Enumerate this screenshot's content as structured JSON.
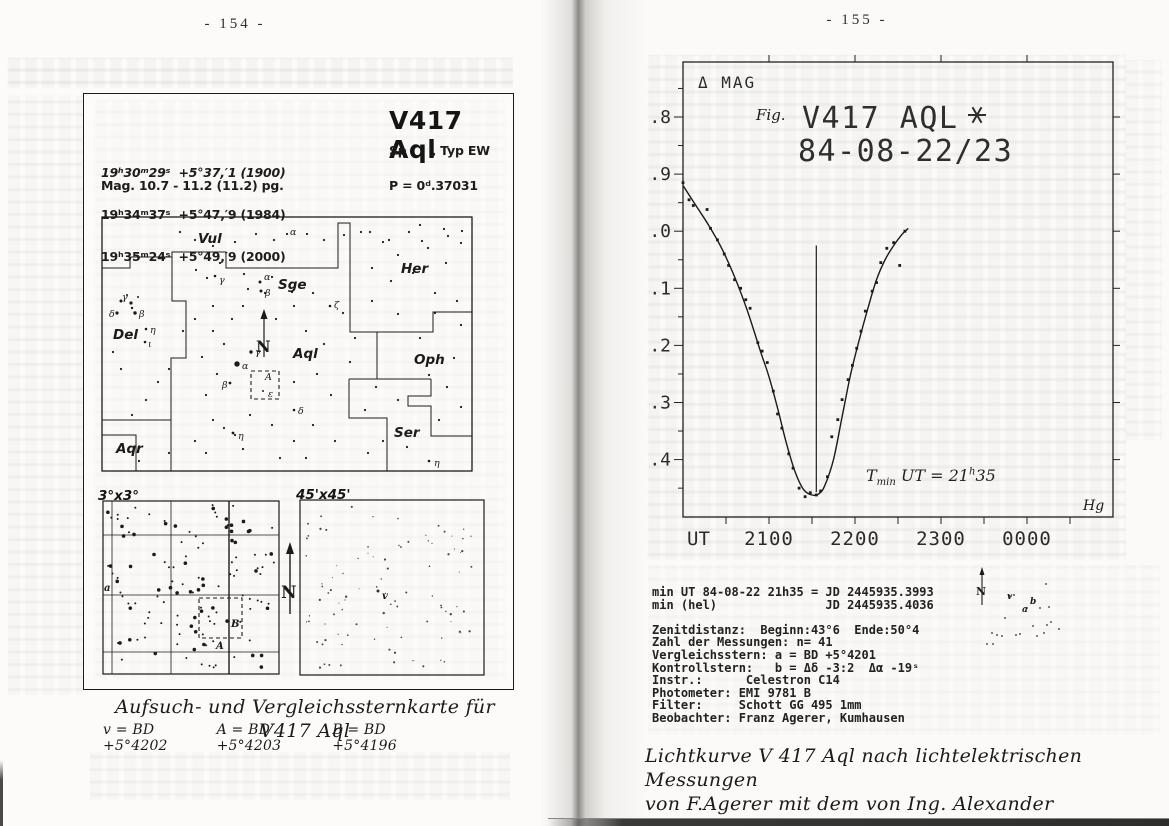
{
  "left": {
    "page_number": "- 154 -",
    "info": {
      "title": "V417 Aql",
      "sp_typ": "Sp      , Typ EW",
      "coordinates": [
        "19ʰ30ᵐ29ˢ  +5°37,′1 (1900)",
        "19ʰ34ᵐ37ˢ  +5°47,′9 (1984)",
        "19ʰ35ᵐ24ˢ  +5°49,′9 (2000)"
      ],
      "magnitude": "Mag. 10.7 - 11.2 (11.2) pg.",
      "period": "P = 0ᵈ.37031"
    },
    "main_map": {
      "north_label": "N",
      "boundaries": [
        [
          [
            0,
            51
          ],
          [
            28,
            51
          ],
          [
            28,
            40
          ],
          [
            70,
            40
          ]
        ],
        [
          [
            70,
            40
          ],
          [
            70,
            35
          ],
          [
            124,
            35
          ],
          [
            124,
            51
          ],
          [
            236,
            51
          ],
          [
            236,
            6
          ],
          [
            248,
            6
          ],
          [
            248,
            115
          ],
          [
            331,
            115
          ],
          [
            331,
            95
          ],
          [
            370,
            95
          ]
        ],
        [
          [
            70,
            35
          ],
          [
            70,
            84
          ],
          [
            84,
            84
          ],
          [
            84,
            141
          ],
          [
            69,
            141
          ],
          [
            69,
            203
          ],
          [
            0,
            203
          ]
        ],
        [
          [
            69,
            203
          ],
          [
            69,
            254
          ]
        ],
        [
          [
            0,
            218
          ],
          [
            34,
            218
          ],
          [
            34,
            254
          ]
        ],
        [
          [
            275,
            115
          ],
          [
            275,
            162
          ]
        ],
        [
          [
            247,
            162
          ],
          [
            329,
            162
          ]
        ],
        [
          [
            247,
            162
          ],
          [
            247,
            201
          ],
          [
            285,
            201
          ],
          [
            285,
            254
          ]
        ],
        [
          [
            329,
            162
          ],
          [
            329,
            179
          ],
          [
            306,
            179
          ],
          [
            306,
            189
          ],
          [
            329,
            189
          ],
          [
            329,
            219
          ],
          [
            370,
            219
          ]
        ]
      ],
      "dashed_box": [
        149,
        154,
        28,
        28
      ],
      "constellation_labels": [
        {
          "t": "Vul",
          "x": 96,
          "y": 26
        },
        {
          "t": "Sge",
          "x": 176,
          "y": 72
        },
        {
          "t": "Her",
          "x": 299,
          "y": 56
        },
        {
          "t": "Del",
          "x": 11,
          "y": 122
        },
        {
          "t": "Aql",
          "x": 191,
          "y": 141
        },
        {
          "t": "Oph",
          "x": 312,
          "y": 147
        },
        {
          "t": "Ser",
          "x": 292,
          "y": 220
        },
        {
          "t": "Aqr",
          "x": 14,
          "y": 236
        }
      ],
      "star_labels": [
        {
          "t": "α",
          "x": 188,
          "y": 18
        },
        {
          "t": "γ",
          "x": 117,
          "y": 66
        },
        {
          "t": "α",
          "x": 162,
          "y": 63
        },
        {
          "t": "β",
          "x": 163,
          "y": 79
        },
        {
          "t": "ζ",
          "x": 232,
          "y": 91
        },
        {
          "t": "γ",
          "x": 20,
          "y": 83
        },
        {
          "t": "δ",
          "x": 7,
          "y": 100
        },
        {
          "t": "β",
          "x": 37,
          "y": 100
        },
        {
          "t": "η",
          "x": 48,
          "y": 116
        },
        {
          "t": "ι",
          "x": 46,
          "y": 130
        },
        {
          "t": "γ",
          "x": 153,
          "y": 138
        },
        {
          "t": "α",
          "x": 140,
          "y": 152
        },
        {
          "t": "β",
          "x": 120,
          "y": 171
        },
        {
          "t": "δ",
          "x": 196,
          "y": 197
        },
        {
          "t": "η",
          "x": 136,
          "y": 222
        },
        {
          "t": "A",
          "x": 163,
          "y": 163
        },
        {
          "t": "ε",
          "x": 166,
          "y": 180
        },
        {
          "t": "η",
          "x": 332,
          "y": 249
        }
      ],
      "stars": [
        [
          78,
          15,
          1.1
        ],
        [
          93,
          23,
          1.1
        ],
        [
          111,
          29,
          1.1
        ],
        [
          133,
          25,
          1.1
        ],
        [
          154,
          17,
          1.1
        ],
        [
          172,
          23,
          1.1
        ],
        [
          185,
          17,
          1.1
        ],
        [
          205,
          17,
          1.1
        ],
        [
          222,
          23,
          1.1
        ],
        [
          242,
          18,
          1.1
        ],
        [
          268,
          15,
          1.1
        ],
        [
          287,
          23,
          1.1
        ],
        [
          307,
          15,
          1.1
        ],
        [
          320,
          24,
          1.1
        ],
        [
          346,
          19,
          1.1
        ],
        [
          360,
          14,
          1.1
        ],
        [
          94,
          53,
          1.1
        ],
        [
          105,
          61,
          1.1
        ],
        [
          113,
          59,
          1.3
        ],
        [
          118,
          46,
          1.1
        ],
        [
          146,
          72,
          1.1
        ],
        [
          158,
          65,
          1.5
        ],
        [
          159,
          74,
          1.5
        ],
        [
          170,
          60,
          1.1
        ],
        [
          190,
          75,
          1.1
        ],
        [
          142,
          57,
          1.1
        ],
        [
          228,
          89,
          1.3
        ],
        [
          259,
          15,
          1.1
        ],
        [
          281,
          25,
          1.1
        ],
        [
          296,
          38,
          1.1
        ],
        [
          270,
          51,
          1.1
        ],
        [
          289,
          64,
          1.1
        ],
        [
          311,
          56,
          1.1
        ],
        [
          326,
          31,
          1.1
        ],
        [
          344,
          46,
          1.1
        ],
        [
          359,
          26,
          1.1
        ],
        [
          333,
          76,
          1.1
        ],
        [
          355,
          84,
          1.1
        ],
        [
          270,
          84,
          1.1
        ],
        [
          296,
          97,
          1.1
        ],
        [
          342,
          12,
          1.1
        ],
        [
          318,
          8,
          1.1
        ],
        [
          19,
          84,
          1.5
        ],
        [
          29,
          86,
          1.6
        ],
        [
          15,
          96,
          1.6
        ],
        [
          33,
          96,
          1.7
        ],
        [
          44,
          112,
          1.3
        ],
        [
          43,
          125,
          1.3
        ],
        [
          25,
          78,
          1.0
        ],
        [
          36,
          80,
          1.0
        ],
        [
          30,
          91,
          1.2
        ],
        [
          149,
          135,
          1.7
        ],
        [
          135,
          147,
          2.7
        ],
        [
          128,
          166,
          1.4
        ],
        [
          192,
          193,
          1.3
        ],
        [
          131,
          216,
          1.4
        ],
        [
          161,
          174,
          1.0
        ],
        [
          111,
          114,
          1.1
        ],
        [
          122,
          127,
          1.1
        ],
        [
          100,
          140,
          1.1
        ],
        [
          115,
          157,
          1.1
        ],
        [
          104,
          178,
          1.1
        ],
        [
          204,
          114,
          1.1
        ],
        [
          222,
          127,
          1.1
        ],
        [
          215,
          157,
          1.1
        ],
        [
          192,
          165,
          1.1
        ],
        [
          229,
          178,
          1.1
        ],
        [
          248,
          145,
          1.1
        ],
        [
          211,
          76,
          1.1
        ],
        [
          192,
          89,
          1.1
        ],
        [
          174,
          102,
          1.1
        ],
        [
          163,
          76,
          1.1
        ],
        [
          141,
          89,
          1.1
        ],
        [
          130,
          102,
          1.1
        ],
        [
          111,
          89,
          1.1
        ],
        [
          93,
          102,
          1.1
        ],
        [
          81,
          114,
          1.1
        ],
        [
          67,
          152,
          1.1
        ],
        [
          56,
          165,
          1.1
        ],
        [
          44,
          183,
          1.1
        ],
        [
          30,
          198,
          1.1
        ],
        [
          19,
          152,
          1.1
        ],
        [
          11,
          135,
          1.1
        ],
        [
          111,
          203,
          1.1
        ],
        [
          122,
          211,
          1.1
        ],
        [
          133,
          218,
          1.1
        ],
        [
          148,
          198,
          1.1
        ],
        [
          170,
          208,
          1.1
        ],
        [
          192,
          224,
          1.1
        ],
        [
          211,
          208,
          1.1
        ],
        [
          233,
          224,
          1.1
        ],
        [
          93,
          224,
          1.1
        ],
        [
          104,
          236,
          1.1
        ],
        [
          178,
          241,
          1.1
        ],
        [
          204,
          241,
          1.1
        ],
        [
          37,
          244,
          1.1
        ],
        [
          67,
          236,
          1.1
        ],
        [
          141,
          232,
          1.1
        ],
        [
          241,
          96,
          1.1
        ],
        [
          253,
          121,
          1.1
        ],
        [
          333,
          96,
          1.1
        ],
        [
          318,
          121,
          1.1
        ],
        [
          359,
          108,
          1.1
        ],
        [
          352,
          141,
          1.1
        ],
        [
          327,
          158,
          1.1
        ],
        [
          345,
          170,
          1.1
        ],
        [
          359,
          190,
          1.1
        ],
        [
          337,
          203,
          1.1
        ],
        [
          274,
          170,
          1.1
        ],
        [
          296,
          183,
          1.1
        ],
        [
          263,
          193,
          1.1
        ],
        [
          281,
          224,
          1.1
        ],
        [
          266,
          236,
          1.1
        ],
        [
          305,
          230,
          1.1
        ],
        [
          327,
          244,
          1.3
        ]
      ]
    },
    "detail_a": {
      "label": "3°x3°",
      "grid_v": [
        9,
        68,
        126
      ],
      "grid_h": [
        34,
        94,
        151
      ],
      "dashed_box": [
        96,
        97,
        43,
        40
      ],
      "labels": [
        {
          "t": "a",
          "x": 1,
          "y": 90
        },
        {
          "t": "B",
          "x": 128,
          "y": 126
        },
        {
          "t": "A",
          "x": 113,
          "y": 148
        }
      ],
      "star_count": 130,
      "seed": 11
    },
    "detail_b": {
      "label": "45'x45'",
      "v_label": {
        "t": "v",
        "x": 82,
        "y": 99
      },
      "star_count": 95,
      "seed": 23
    },
    "north_label": "N",
    "caption_title": "Aufsuch- und Vergleichssternkarte für V417 Aql",
    "caption_stars": [
      "v = BD +5°4202",
      "A = BD +5°4203",
      "B = BD +5°4196"
    ]
  },
  "right": {
    "page_number": "- 155 -",
    "lightcurve": {
      "ylabel": "Δ MAG",
      "fig": "Fig.",
      "title1": "V417 AQL",
      "title2": "84-08-22/23",
      "xlabel": "UT",
      "signature": "Hg",
      "annotation": {
        "pre": "T",
        "sub": "min",
        "mid": " UT = 21",
        "sup": "h",
        "post": "35"
      }
    },
    "info_lines": [
      "min UT 84-08-22 21h35 = JD 2445935.3993",
      "min (hel)               JD 2445935.4036",
      "",
      "Zenitdistanz:  Beginn:43°6  Ende:50°4",
      "Zahl der Messungen: n= 41",
      "Vergleichsstern: a = BD +5°4201",
      "Kontrollstern:   b = Δδ -3:2  Δα -19ˢ",
      "Instr.:      Celestron C14",
      "Photometer: EMI 9781 B",
      "Filter:     Schott GG 495 1mm",
      "Beobachter: Franz Agerer, Kumhausen"
    ],
    "inset_map": {
      "north": "N",
      "labels": [
        {
          "t": "v",
          "x": 54,
          "y": 36
        },
        {
          "t": "a",
          "x": 69,
          "y": 49
        },
        {
          "t": "b",
          "x": 77,
          "y": 41
        }
      ],
      "dots": [
        [
          93,
          21
        ],
        [
          57,
          33
        ],
        [
          61,
          32
        ],
        [
          74,
          45
        ],
        [
          87,
          45
        ],
        [
          96,
          44
        ],
        [
          52,
          55
        ],
        [
          80,
          63
        ],
        [
          94,
          62
        ],
        [
          98,
          59
        ],
        [
          106,
          66
        ],
        [
          63,
          72
        ],
        [
          67,
          71
        ],
        [
          39,
          70
        ],
        [
          44,
          72
        ],
        [
          49,
          73
        ],
        [
          34,
          81
        ],
        [
          40,
          81
        ],
        [
          91,
          70
        ],
        [
          84,
          73
        ]
      ]
    },
    "caption_lines": [
      "Lichtkurve V 417 Aql nach lichtelektrischen Messungen",
      "von F.Agerer mit dem von Ing. Alexander Schnitzer, Er-",
      "langen, gebauten Amateur-Photometer."
    ]
  },
  "chart_data": {
    "type": "scatter",
    "title": "V417 AQL* 84-08-22/23",
    "xlabel": "UT",
    "ylabel": "Δ MAG",
    "x_ticks_hours": [
      21,
      22,
      23,
      24
    ],
    "x_tick_labels": [
      "2100",
      "2200",
      "2300",
      "0000"
    ],
    "xlim_hours": [
      20.0,
      25.0
    ],
    "y_ticks": [
      1.8,
      1.9,
      2.0,
      2.1,
      2.2,
      2.3,
      2.4
    ],
    "ylim": [
      1.7,
      2.5
    ],
    "y_axis_inverted": true,
    "grid": false,
    "t_min_ut_hours": 21.55,
    "t_min_label": "21h35",
    "points": [
      [
        20.0,
        1.915
      ],
      [
        20.07,
        1.945
      ],
      [
        20.12,
        1.955
      ],
      [
        20.28,
        1.962
      ],
      [
        20.32,
        1.995
      ],
      [
        20.4,
        2.015
      ],
      [
        20.48,
        2.04
      ],
      [
        20.53,
        2.06
      ],
      [
        20.6,
        2.085
      ],
      [
        20.67,
        2.1
      ],
      [
        20.73,
        2.12
      ],
      [
        20.78,
        2.135
      ],
      [
        20.87,
        2.195
      ],
      [
        20.92,
        2.21
      ],
      [
        20.98,
        2.23
      ],
      [
        21.05,
        2.28
      ],
      [
        21.1,
        2.32
      ],
      [
        21.15,
        2.345
      ],
      [
        21.23,
        2.39
      ],
      [
        21.28,
        2.415
      ],
      [
        21.35,
        2.45
      ],
      [
        21.42,
        2.465
      ],
      [
        21.48,
        2.458
      ],
      [
        21.55,
        2.462
      ],
      [
        21.6,
        2.455
      ],
      [
        21.68,
        2.43
      ],
      [
        21.73,
        2.36
      ],
      [
        21.8,
        2.33
      ],
      [
        21.85,
        2.295
      ],
      [
        21.92,
        2.26
      ],
      [
        21.97,
        2.235
      ],
      [
        22.02,
        2.205
      ],
      [
        22.07,
        2.175
      ],
      [
        22.12,
        2.14
      ],
      [
        22.2,
        2.105
      ],
      [
        22.25,
        2.09
      ],
      [
        22.3,
        2.055
      ],
      [
        22.37,
        2.03
      ],
      [
        22.45,
        2.02
      ],
      [
        22.52,
        2.06
      ],
      [
        22.58,
        2.0
      ]
    ],
    "fit_curve": [
      [
        20.0,
        1.92
      ],
      [
        20.15,
        1.955
      ],
      [
        20.3,
        1.99
      ],
      [
        20.45,
        2.03
      ],
      [
        20.6,
        2.08
      ],
      [
        20.75,
        2.14
      ],
      [
        20.9,
        2.21
      ],
      [
        21.0,
        2.255
      ],
      [
        21.1,
        2.31
      ],
      [
        21.2,
        2.37
      ],
      [
        21.3,
        2.42
      ],
      [
        21.4,
        2.452
      ],
      [
        21.5,
        2.462
      ],
      [
        21.58,
        2.46
      ],
      [
        21.65,
        2.445
      ],
      [
        21.75,
        2.4
      ],
      [
        21.85,
        2.325
      ],
      [
        21.95,
        2.25
      ],
      [
        22.05,
        2.19
      ],
      [
        22.15,
        2.135
      ],
      [
        22.25,
        2.085
      ],
      [
        22.35,
        2.05
      ],
      [
        22.45,
        2.025
      ],
      [
        22.55,
        2.005
      ],
      [
        22.62,
        1.995
      ]
    ]
  }
}
